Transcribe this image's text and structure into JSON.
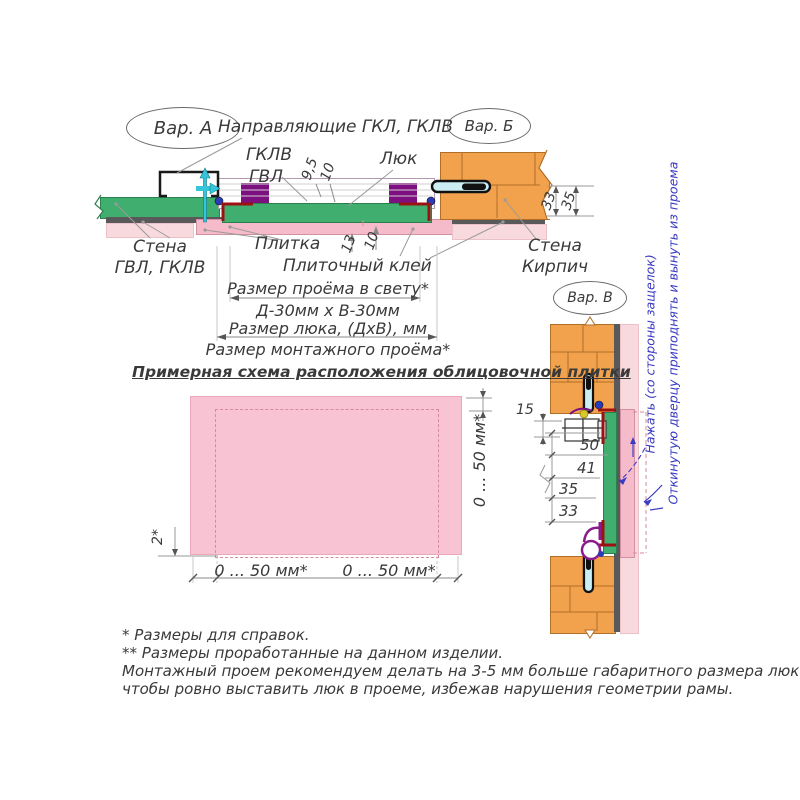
{
  "colors": {
    "green_wall": "#3fae6e",
    "brick_orange": "#f2a24c",
    "tile_pink": "#f6bbca",
    "finish_pink": "#f8dade",
    "glue_gray": "#595959",
    "frame_purple": "#7d0f80",
    "bracket_red": "#9c1212",
    "screw_cyan": "#35c4d8",
    "note_blue": "#3b3bc4",
    "scheme_pink": "#f8c3d2"
  },
  "variants": {
    "a": "Вар. А",
    "b": "Вар. Б",
    "v": "Вар. В"
  },
  "top_section": {
    "labels": {
      "guides": "Направляющие ГКЛ, ГКЛВ",
      "gklv": "ГКЛВ",
      "gvl": "ГВЛ",
      "hatch": "Люк",
      "wall_left_line1": "Стена",
      "wall_left_line2": "ГВЛ, ГКЛВ",
      "tile": "Плитка",
      "tile_glue": "Плиточный клей",
      "wall_right_line1": "Стена",
      "wall_right_line2": "Кирпич"
    },
    "dims": {
      "frame_front": "9,5",
      "frame_depth": "10",
      "tile_13": "13",
      "glue_10": "10",
      "wall_33": "33",
      "wall_35": "35"
    },
    "size_rows": [
      "Размер проёма в свету*",
      "Д-30мм х В-30мм",
      "Размер люка, (ДхВ), мм",
      "Размер монтажного проёма*"
    ]
  },
  "tile_scheme": {
    "title": "Примерная схема расположения облицовочной плитки",
    "dim_right_vertical": "0 ... 50 мм*",
    "dim_left_vertical": "2*",
    "dim_bottom_left": "0 ... 50 мм*",
    "dim_bottom_right": "0 ... 50 мм*"
  },
  "variant_v": {
    "dims": {
      "d15": "15",
      "d50": "50",
      "d41": "41",
      "d35": "35",
      "d33": "33"
    },
    "note_press": "Нажать (со стороны защелок)",
    "note_remove": "Откинутую дверцу приподнять и вынуть из проема"
  },
  "footnotes": [
    "* Размеры для справок.",
    "** Размеры проработанные на данном изделии.",
    "Монтажный проем рекомендуем делать на 3-5 мм больше габаритного размера люка,",
    "чтобы ровно выставить люк в проеме, избежав нарушения геометрии рамы."
  ]
}
